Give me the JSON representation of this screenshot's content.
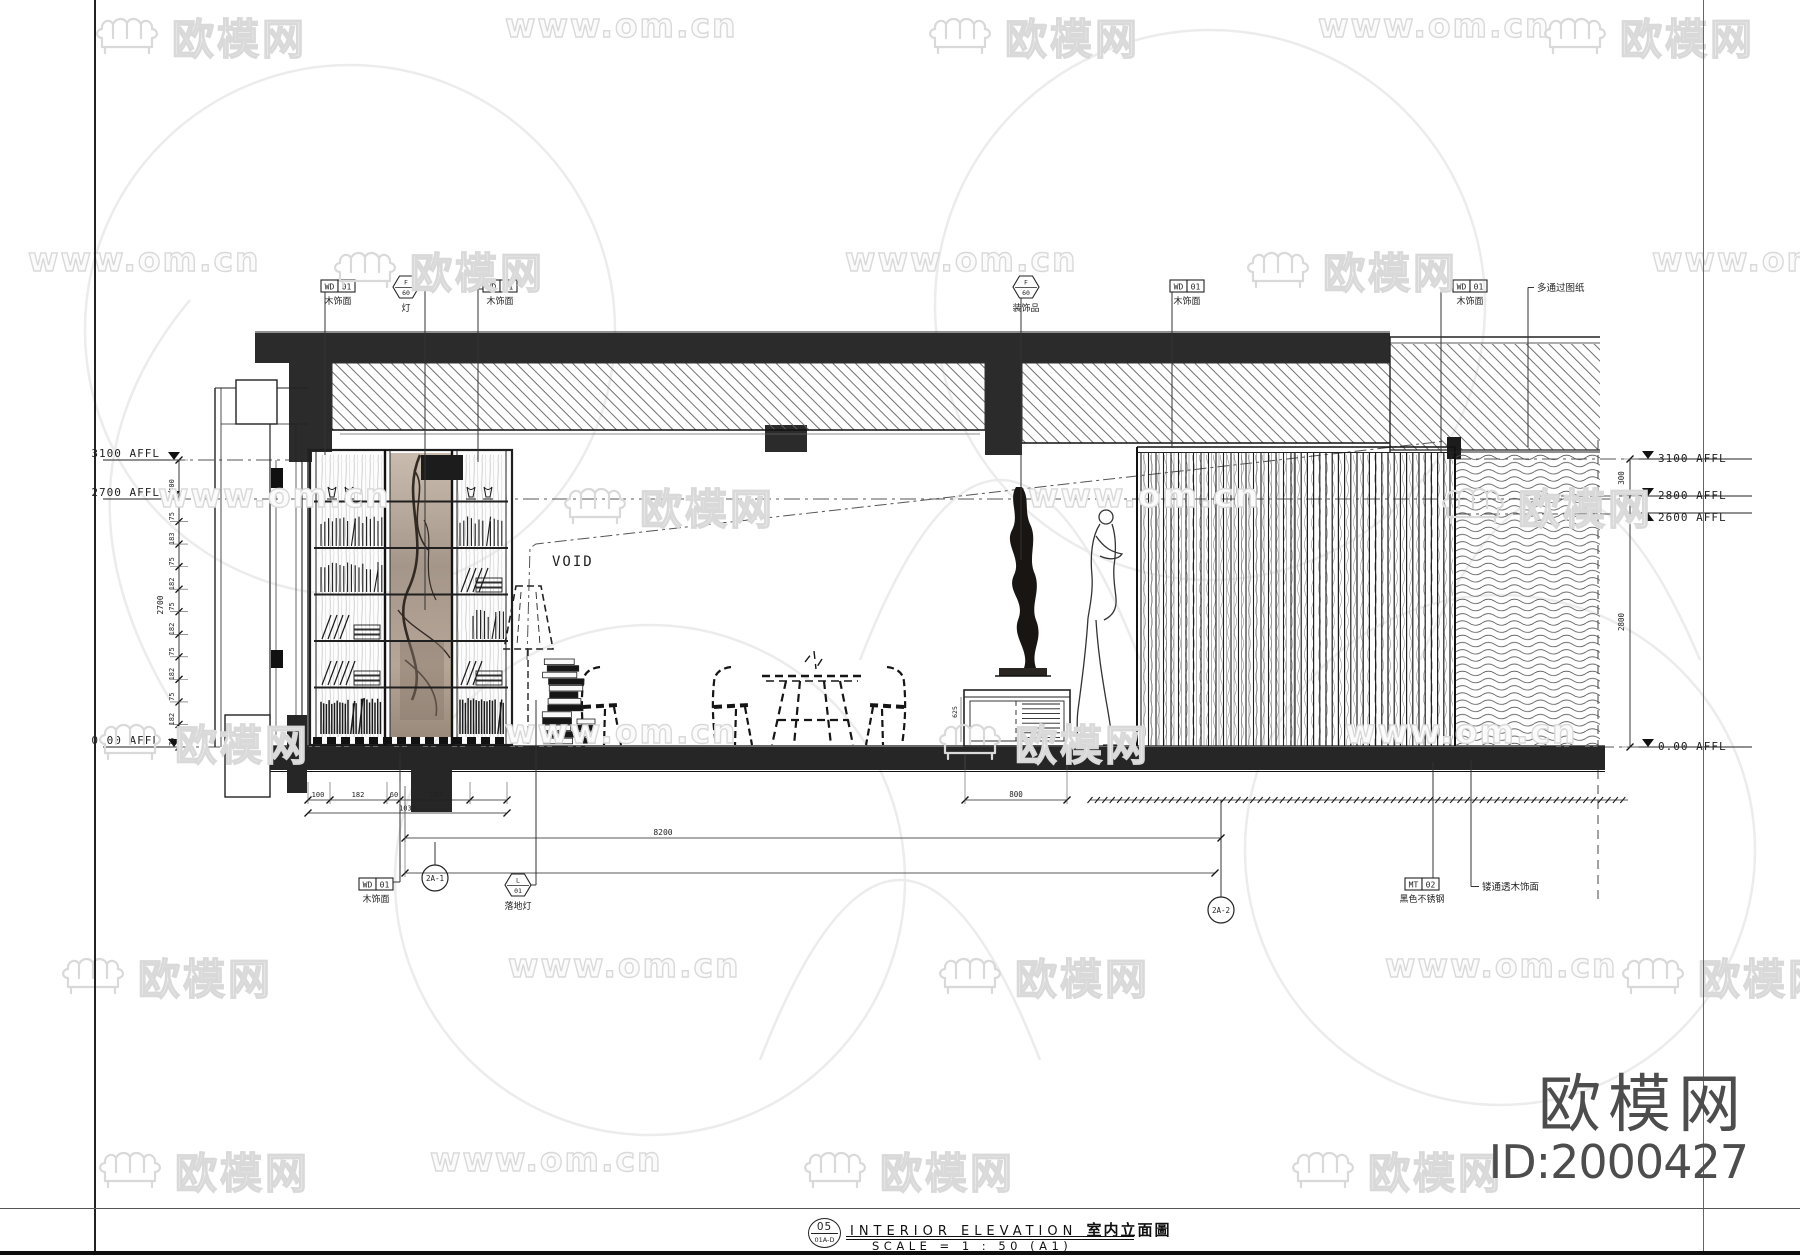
{
  "watermark": {
    "brand": "欧模网",
    "site": "www.om.cn"
  },
  "watermark_rows": [
    {
      "y": 6,
      "items": [
        {
          "t": "logo",
          "x": 92
        },
        {
          "t": "site",
          "x": 505
        },
        {
          "t": "logo",
          "x": 925
        },
        {
          "t": "site",
          "x": 1318
        },
        {
          "t": "logo",
          "x": 1540
        }
      ]
    },
    {
      "y": 240,
      "items": [
        {
          "t": "site",
          "x": 28
        },
        {
          "t": "logo",
          "x": 330
        },
        {
          "t": "site",
          "x": 845
        },
        {
          "t": "logo",
          "x": 1243
        },
        {
          "t": "site",
          "x": 1652
        }
      ]
    },
    {
      "y": 476,
      "items": [
        {
          "t": "site",
          "x": 158
        },
        {
          "t": "logo",
          "x": 560
        },
        {
          "t": "site",
          "x": 1028
        },
        {
          "t": "logo",
          "x": 1438
        }
      ]
    },
    {
      "y": 712,
      "items": [
        {
          "t": "logo",
          "x": 95
        },
        {
          "t": "site",
          "x": 505
        },
        {
          "t": "logo",
          "x": 935
        },
        {
          "t": "site",
          "x": 1345
        }
      ]
    },
    {
      "y": 946,
      "items": [
        {
          "t": "logo",
          "x": 58
        },
        {
          "t": "site",
          "x": 508
        },
        {
          "t": "logo",
          "x": 935
        },
        {
          "t": "site",
          "x": 1385
        },
        {
          "t": "logo",
          "x": 1618
        }
      ]
    },
    {
      "y": 1140,
      "items": [
        {
          "t": "logo",
          "x": 95
        },
        {
          "t": "site",
          "x": 430
        },
        {
          "t": "logo",
          "x": 800
        },
        {
          "t": "logo",
          "x": 1288
        }
      ]
    }
  ],
  "brand_plate": {
    "name": "欧模网",
    "id": "ID:2000427"
  },
  "title_block": {
    "number": "05",
    "sheet": "01A-D",
    "title_en": "INTERIOR ELEVATION",
    "title_cn": "室内立面圖",
    "scale": "SCALE = 1 : 50 (A1)"
  },
  "drawing": {
    "void_label": "VOID",
    "levels_left": [
      {
        "text": "3100 AFFL",
        "y": 460
      },
      {
        "text": "2700 AFFL",
        "y": 499
      },
      {
        "text": "0.00 AFFL",
        "y": 747
      }
    ],
    "levels_right": [
      {
        "text": "3100 AFFL",
        "y": 459,
        "dir": "down"
      },
      {
        "text": "2800 AFFL",
        "y": 496,
        "dir": "down"
      },
      {
        "text": "2600 AFFL",
        "y": 513,
        "dir": "up"
      },
      {
        "text": "0.00 AFFL",
        "y": 747,
        "dir": "down"
      }
    ],
    "tags_top": [
      {
        "type": "rect",
        "code": "WD",
        "num": "01",
        "label": "木饰面",
        "x": 338,
        "lx": 325,
        "ly": 455
      },
      {
        "type": "hex",
        "top": "F",
        "bot": "60",
        "label": "灯",
        "x": 406,
        "lx": 425,
        "ly": 610
      },
      {
        "type": "rect",
        "code": "WD",
        "num": "01",
        "label": "木饰面",
        "x": 500,
        "lx": 478,
        "ly": 462
      },
      {
        "type": "hex",
        "top": "F",
        "bot": "60",
        "label": "装饰品",
        "x": 1026,
        "lx": 1021,
        "ly": 560
      },
      {
        "type": "rect",
        "code": "WD",
        "num": "01",
        "label": "木饰面",
        "x": 1187,
        "lx": 1172,
        "ly": 448
      },
      {
        "type": "rect",
        "code": "WD",
        "num": "01",
        "label": "木饰面",
        "x": 1470,
        "lx": 1441,
        "ly": 452
      }
    ],
    "tags_bottom": [
      {
        "type": "rect",
        "code": "WD",
        "num": "01",
        "label": "木饰面",
        "x": 376,
        "y": 884,
        "lx": 400,
        "ly": 753
      },
      {
        "type": "hex",
        "top": "L",
        "bot": "01",
        "label": "落地灯",
        "x": 518,
        "y": 885,
        "lx": 536,
        "ly": 700
      },
      {
        "type": "rect",
        "code": "MT",
        "num": "02",
        "label": "黑色不锈钢",
        "x": 1422,
        "y": 884,
        "lx": 1433,
        "ly": 762
      }
    ],
    "notes": [
      {
        "text": "多通过图纸",
        "x": 1537,
        "y": 291,
        "lx": 1528,
        "ly": 447,
        "dir": "down"
      },
      {
        "text": "镂通透木饰面",
        "x": 1482,
        "y": 890,
        "lx": 1471,
        "ly": 760,
        "dir": "up"
      }
    ],
    "bubbles": [
      {
        "text": "2A-1",
        "x": 435,
        "y": 878,
        "lx": 435,
        "l1": 842,
        "l2": 865
      },
      {
        "text": "2A-2",
        "x": 1221,
        "y": 910,
        "lx": 1221,
        "l1": 800,
        "l2": 897
      }
    ],
    "dim_left": {
      "x": 179,
      "top": 460,
      "bottom": 747,
      "labels": [
        "400",
        "75",
        "183",
        "75",
        "182",
        "75",
        "182",
        "75",
        "182",
        "75",
        "182",
        "75"
      ],
      "overall": "2700"
    },
    "dim_right": {
      "x": 1630,
      "ticks": [
        459,
        496,
        747
      ],
      "labels": [
        {
          "t": "300",
          "y": 478
        },
        {
          "t": "2800",
          "y": 622
        }
      ]
    },
    "dims_bottom": {
      "row1": {
        "y": 800,
        "ticks": [
          308,
          330,
          387,
          400,
          470,
          507
        ],
        "labels": [
          {
            "t": "100",
            "x": 318
          },
          {
            "t": "182",
            "x": 358
          },
          {
            "t": "60",
            "x": 394
          },
          {
            "t": "182",
            "x": 436
          }
        ]
      },
      "row1b": {
        "y": 813,
        "x1": 308,
        "x2": 507,
        "label": "1030"
      },
      "cabinet": {
        "y": 800,
        "x1": 965,
        "x2": 1067,
        "label": "800"
      },
      "row2": {
        "y": 838,
        "x1": 405,
        "x2": 1221,
        "label": "8200"
      },
      "row3": {
        "y": 873,
        "x1": 405,
        "x2": 1215,
        "label": ""
      },
      "slat_ticks": {
        "y": 800,
        "x1": 1090,
        "x2": 1628,
        "step": 7.4
      },
      "cab_height": {
        "label": "625",
        "x": 957,
        "y": 712
      }
    }
  }
}
